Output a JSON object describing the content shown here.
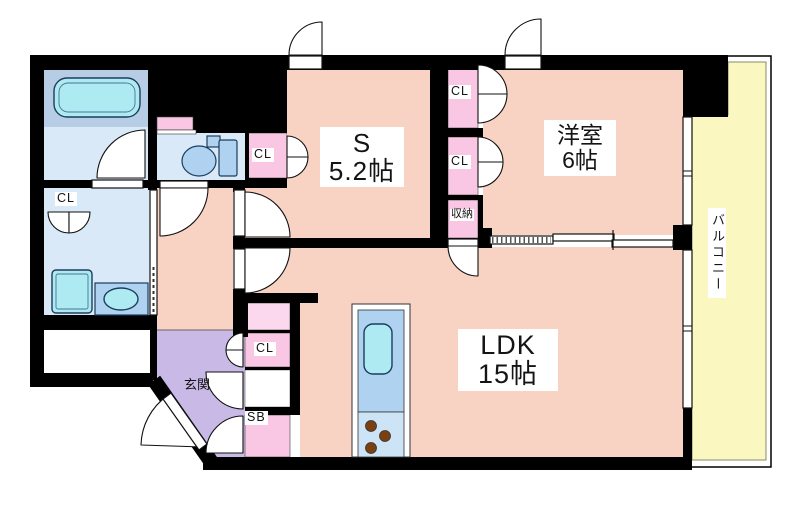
{
  "rooms": {
    "service": {
      "name": "S",
      "size": "5.2帖"
    },
    "western": {
      "name": "洋室",
      "size": "6帖"
    },
    "ldk": {
      "name": "LDK",
      "size": "15帖"
    },
    "entrance": {
      "name": "玄関"
    },
    "balcony": {
      "name": "バルコニー"
    }
  },
  "labels": {
    "closet": "CL",
    "storage": "収納",
    "shoe_box": "SB"
  },
  "colors": {
    "wall": "#000000",
    "room": "#f8d3c4",
    "balcony": "#fbf7c0",
    "entrance": "#c9b9e6",
    "closet_pink": "#f9c6e3",
    "closet_light_pink": "#fbd8ee",
    "wet_area_floor": "#d9e9f8",
    "tub_zone": "#b7cde6",
    "fixture_blue": "#aed2f0",
    "fixture_cyan": "#aeeaf2",
    "kitchen_counter_top": "#aed2f0",
    "kitchen_counter_bottom": "#cde4f7",
    "burner_brown": "#7a4010"
  }
}
